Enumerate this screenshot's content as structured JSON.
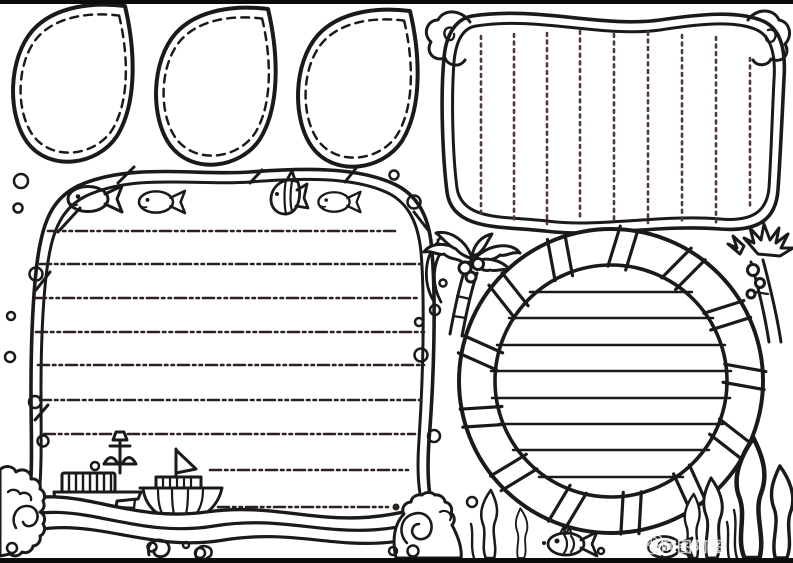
{
  "artwork": {
    "type": "ocean-themed hand-drawn newspaper (shouchaobao) line-art template, black ink on white",
    "background_color": "#ffffff",
    "ink_color": "#1a1a1a",
    "writing_guide_color": "#3a2b25"
  },
  "panels": {
    "teardrop_cutouts": {
      "count": 3,
      "border_style": "solid outline with dashed inner line",
      "position": "top-left row"
    },
    "left_writing_panel": {
      "border_style": "twisted rope frame with wave-and-splash bottom",
      "writing_line_style": "dash-dot horizontal",
      "full_writing_lines": 7,
      "short_writing_lines": 2,
      "decorations": [
        "fish",
        "fish",
        "angelfish",
        "fish",
        "bubbles",
        "cargo ship",
        "sailboat",
        "sea waves",
        "wave curls",
        "splash clouds"
      ]
    },
    "vertical_writing_panel": {
      "border_style": "wavy double ribbon with curly cloud corners",
      "writing_line_style": "dotted vertical",
      "vertical_writing_lines": 9,
      "position": "top-right"
    },
    "life_ring_panel": {
      "border_style": "striped swim ring",
      "stripe_pairs": 13,
      "writing_line_style": "solid horizontal",
      "writing_lines": 8,
      "position": "bottom-right"
    }
  },
  "decorations": {
    "palm_trees": 2,
    "seaweed_strands": 7,
    "coral_with_spiral": 1,
    "bottom_fish": 2,
    "bubbles": "scattered small circles"
  },
  "watermark": {
    "icon": "weibo-eye",
    "text": "@阿图阿图"
  }
}
